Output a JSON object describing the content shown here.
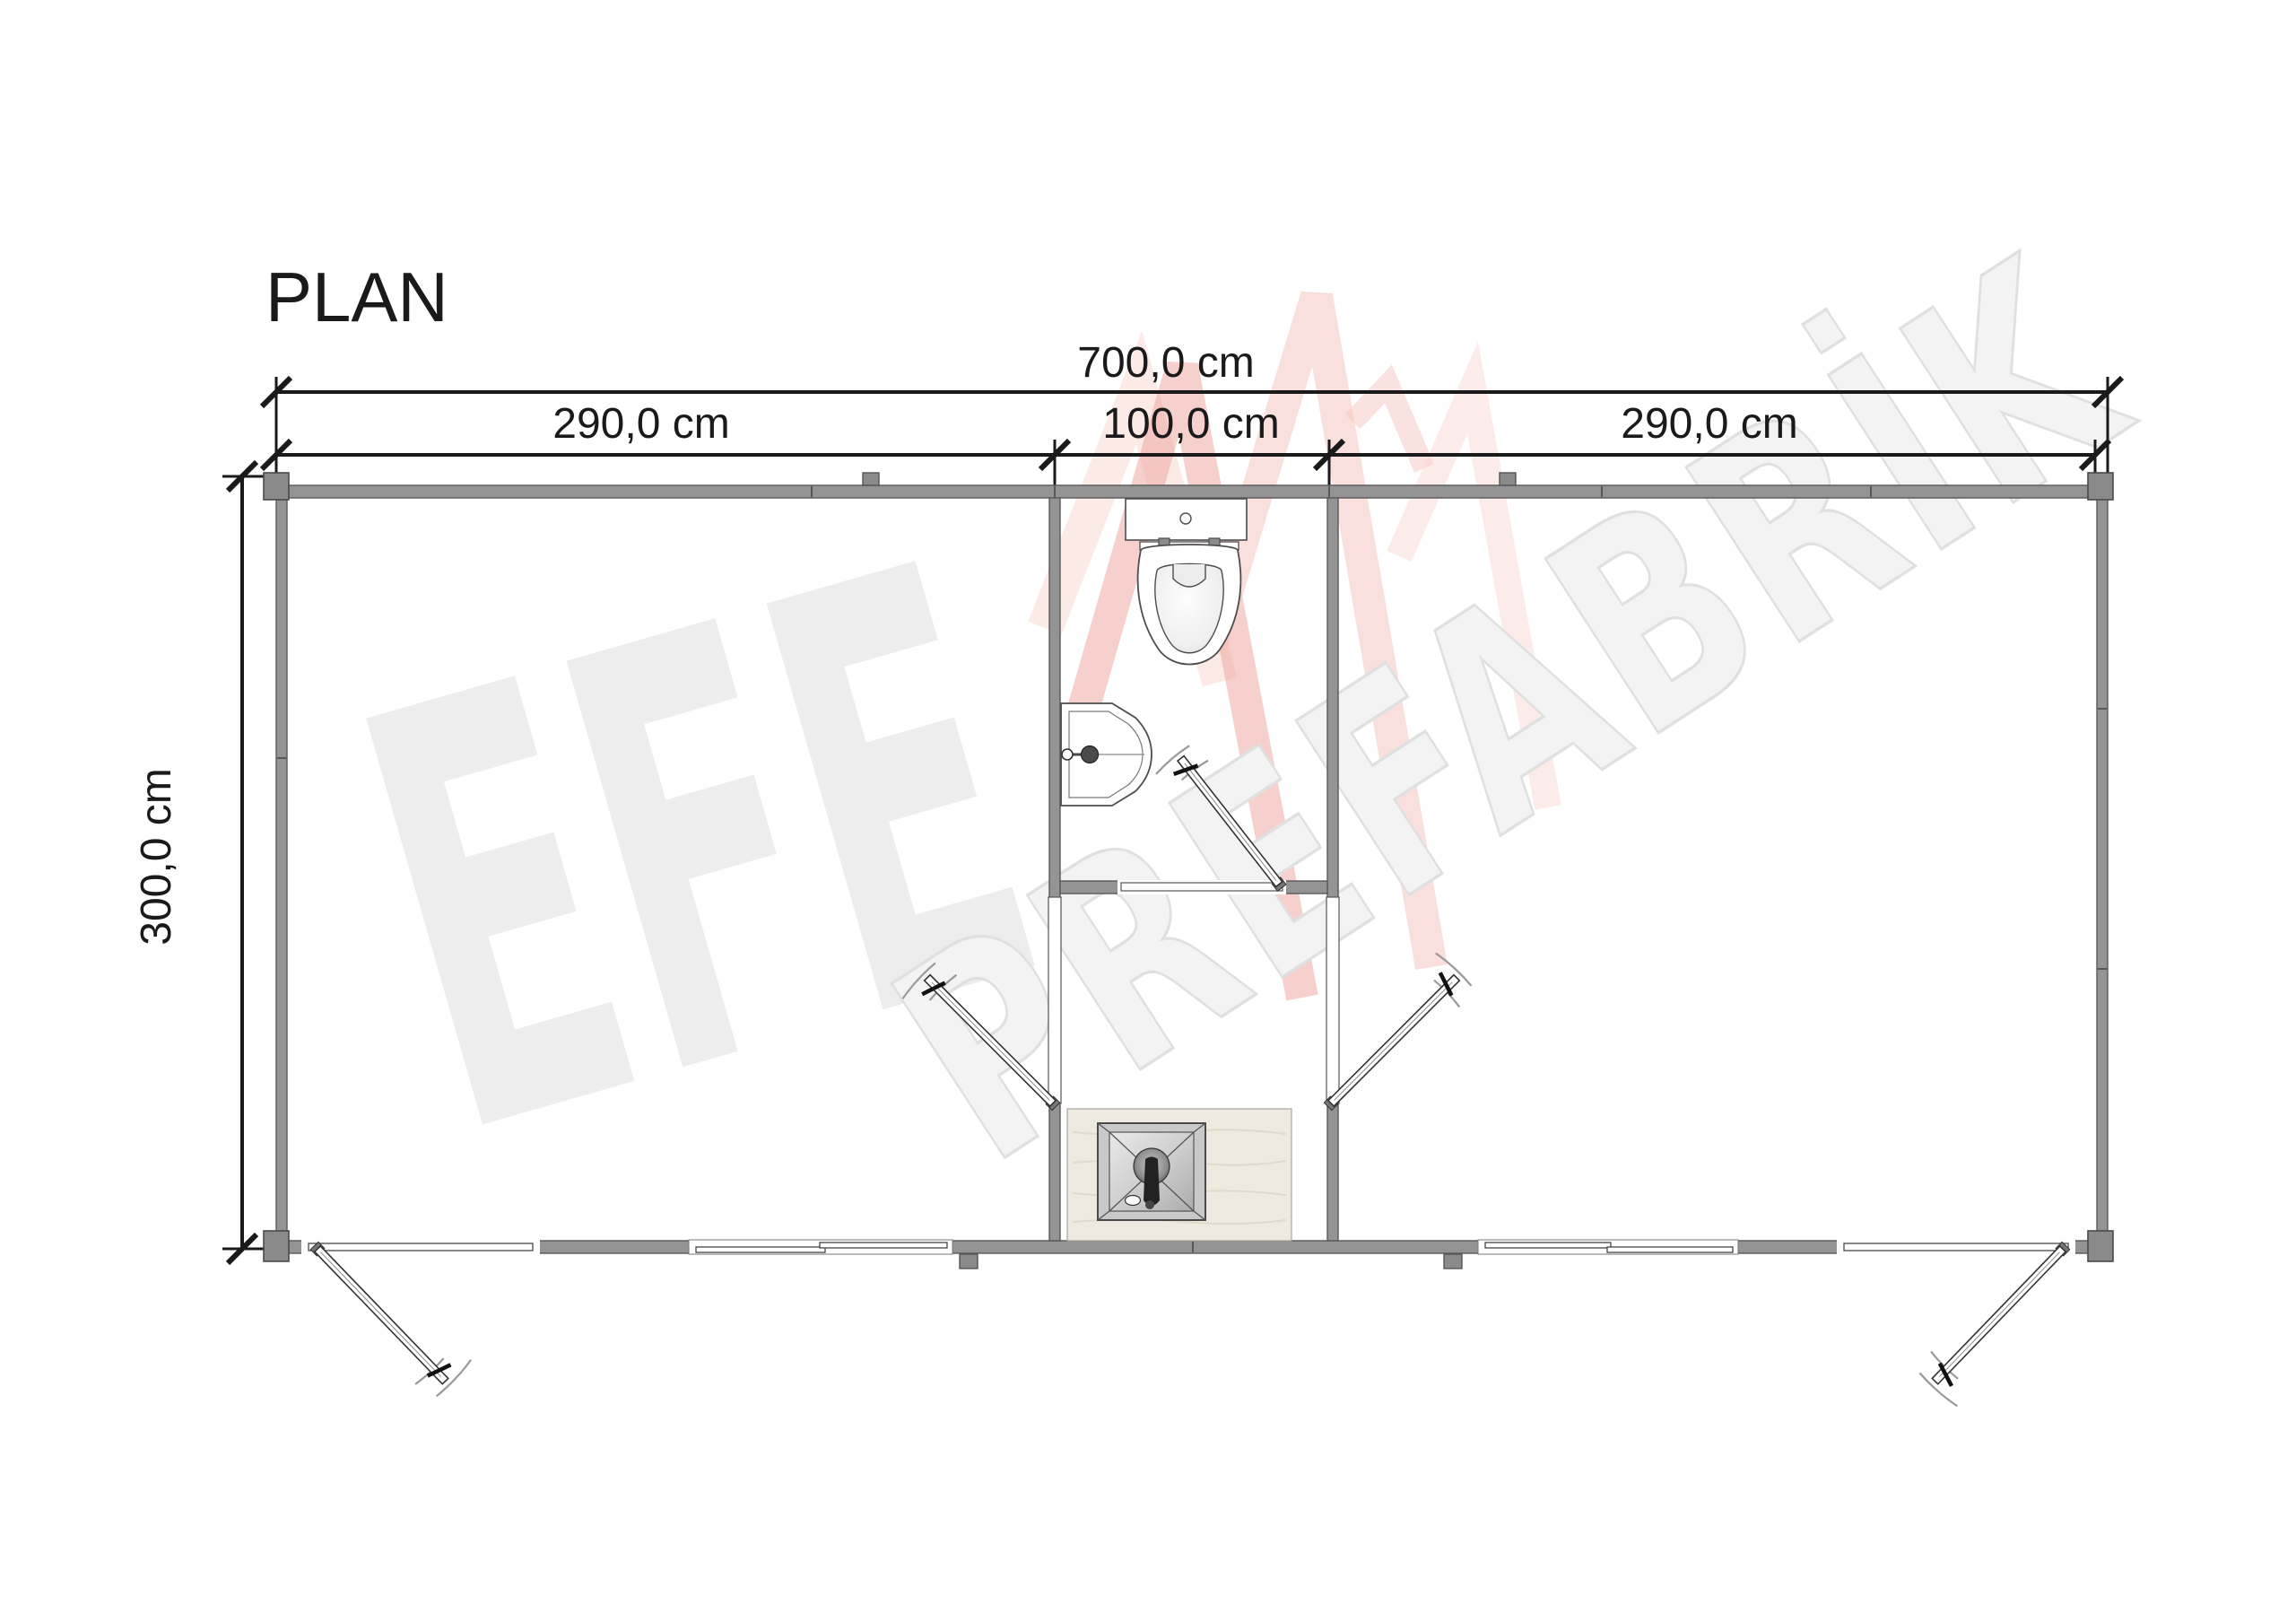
{
  "title": "PLAN",
  "dimensions": {
    "total_width": "700,0 cm",
    "left_section": "290,0 cm",
    "middle_section": "100,0 cm",
    "right_section": "290,0 cm",
    "depth": "300,0 cm"
  },
  "watermark": {
    "brand": "EFE",
    "brand_suffix": "PREFABRİK"
  },
  "colors": {
    "wall": "#949494",
    "wall_outline": "#595959",
    "post": "#8a8a8a",
    "dimension_line": "#1a1a1a",
    "watermark_text": "#ededed",
    "watermark_fill": "#f3f3f3",
    "watermark_outline": "#e0e0e0",
    "watermark_logo_strong": "#efa59d",
    "watermark_logo_light": "#f6c9c2",
    "shower_floor": "#efeae0"
  }
}
